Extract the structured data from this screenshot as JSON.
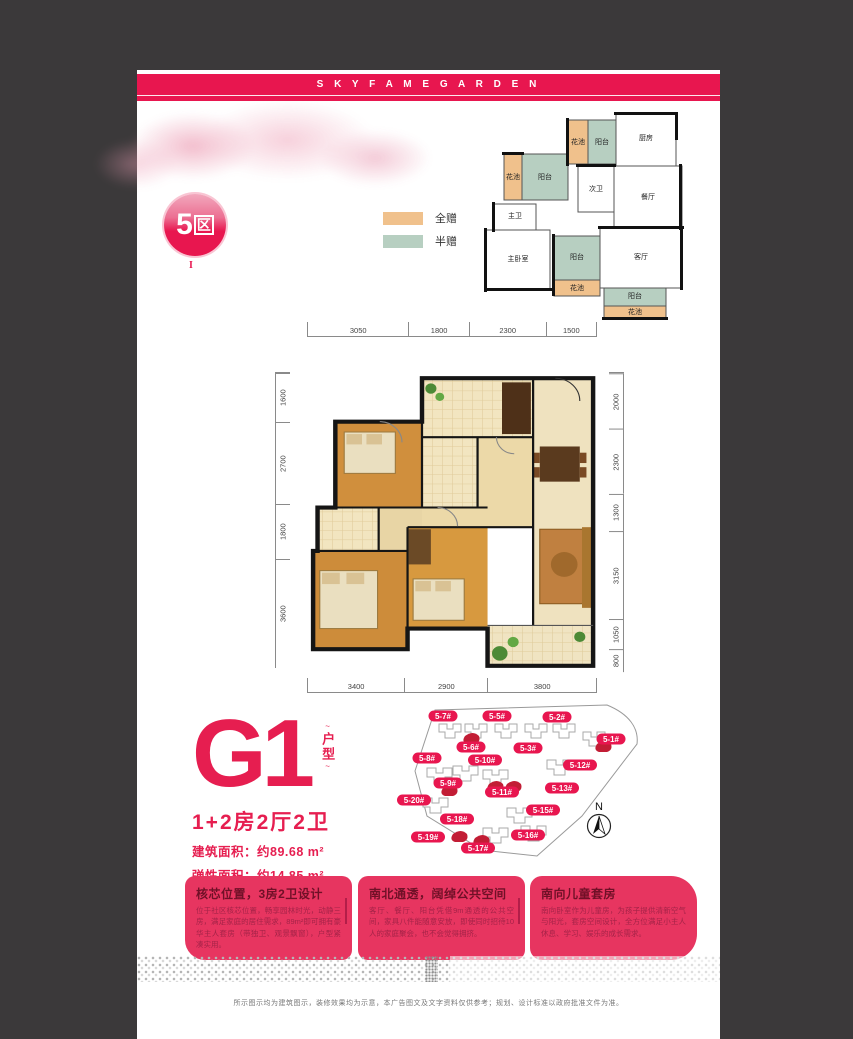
{
  "brand": {
    "header_letters": "S K Y F A M E G A R D E N"
  },
  "zone": {
    "badge_number": "5",
    "badge_suffix": "区",
    "tick": "I"
  },
  "legend": {
    "items": [
      {
        "label": "全赠",
        "color": "#f0c18c"
      },
      {
        "label": "半赠",
        "color": "#b7cfc1"
      }
    ]
  },
  "mini_plan": {
    "rooms": [
      {
        "label": "花池",
        "x": 100,
        "y": 36
      },
      {
        "label": "阳台",
        "x": 124,
        "y": 36
      },
      {
        "label": "厨房",
        "x": 168,
        "y": 32
      },
      {
        "label": "次卫",
        "x": 118,
        "y": 83
      },
      {
        "label": "餐厅",
        "x": 170,
        "y": 91
      },
      {
        "label": "花池",
        "x": 35,
        "y": 71
      },
      {
        "label": "阳台",
        "x": 67,
        "y": 71
      },
      {
        "label": "主卫",
        "x": 37,
        "y": 110
      },
      {
        "label": "主卧室",
        "x": 40,
        "y": 153
      },
      {
        "label": "阳台",
        "x": 99,
        "y": 151
      },
      {
        "label": "花池",
        "x": 99,
        "y": 182
      },
      {
        "label": "客厅",
        "x": 163,
        "y": 151
      },
      {
        "label": "阳台",
        "x": 157,
        "y": 190
      },
      {
        "label": "花池",
        "x": 157,
        "y": 206
      }
    ]
  },
  "dims": {
    "top": [
      "3050",
      "1800",
      "2300",
      "1500"
    ],
    "left": [
      "1600",
      "2700",
      "1800",
      "3600"
    ],
    "right": [
      "2000",
      "2300",
      "1300",
      "3150",
      "1050",
      "800"
    ],
    "bottom": [
      "3400",
      "2900",
      "3800"
    ]
  },
  "unit": {
    "code": "G1",
    "type_label": "户型",
    "layout": "1+2房2厅2卫",
    "area_build": "建筑面积：约89.68 m²",
    "area_flex": "弹性面积：约14.85 m²"
  },
  "site_plan": {
    "north_label": "N",
    "buildings": [
      {
        "label": "5-7#",
        "x": 56,
        "y": 20
      },
      {
        "label": "5-5#",
        "x": 110,
        "y": 20
      },
      {
        "label": "5-2#",
        "x": 170,
        "y": 21
      },
      {
        "label": "5-6#",
        "x": 84,
        "y": 51
      },
      {
        "label": "5-3#",
        "x": 141,
        "y": 52
      },
      {
        "label": "5-1#",
        "x": 224,
        "y": 43
      },
      {
        "label": "5-8#",
        "x": 40,
        "y": 62
      },
      {
        "label": "5-10#",
        "x": 98,
        "y": 64
      },
      {
        "label": "5-12#",
        "x": 193,
        "y": 69
      },
      {
        "label": "5-9#",
        "x": 61,
        "y": 87
      },
      {
        "label": "5-11#",
        "x": 115,
        "y": 96
      },
      {
        "label": "5-13#",
        "x": 175,
        "y": 92
      },
      {
        "label": "5-20#",
        "x": 27,
        "y": 104
      },
      {
        "label": "5-15#",
        "x": 156,
        "y": 114
      },
      {
        "label": "5-18#",
        "x": 70,
        "y": 123
      },
      {
        "label": "5-16#",
        "x": 141,
        "y": 139
      },
      {
        "label": "5-19#",
        "x": 41,
        "y": 141
      },
      {
        "label": "5-17#",
        "x": 91,
        "y": 152
      }
    ]
  },
  "features": [
    {
      "title": "核芯位置，3房2卫设计",
      "body": "位于社区核芯位置，畅享园林时光，动静三房，满足家庭的居住需求，89m²即可拥有豪华主人套房（带独卫、观景飘窗），户型紧凑实用。"
    },
    {
      "title": "南北通透，阔绰公共空间",
      "body": "客厅、餐厅、阳台凭借9m通透的公共空间，家具八件能随意安放，即使同时招待10人的家庭聚会，也不会觉得拥挤。"
    },
    {
      "title": "南向儿童套房",
      "body": "南向卧室作为儿童房，为孩子提供清新空气与阳光，套房空间设计，全方位满足小主人休息、学习、娱乐的成长需求。"
    }
  ],
  "footer": {
    "disclaimer": "所示图示均为建筑图示，装修效果均为示意，本广告图文及文字资料仅供参考；规划、设计标准以政府批准文件为准。"
  }
}
